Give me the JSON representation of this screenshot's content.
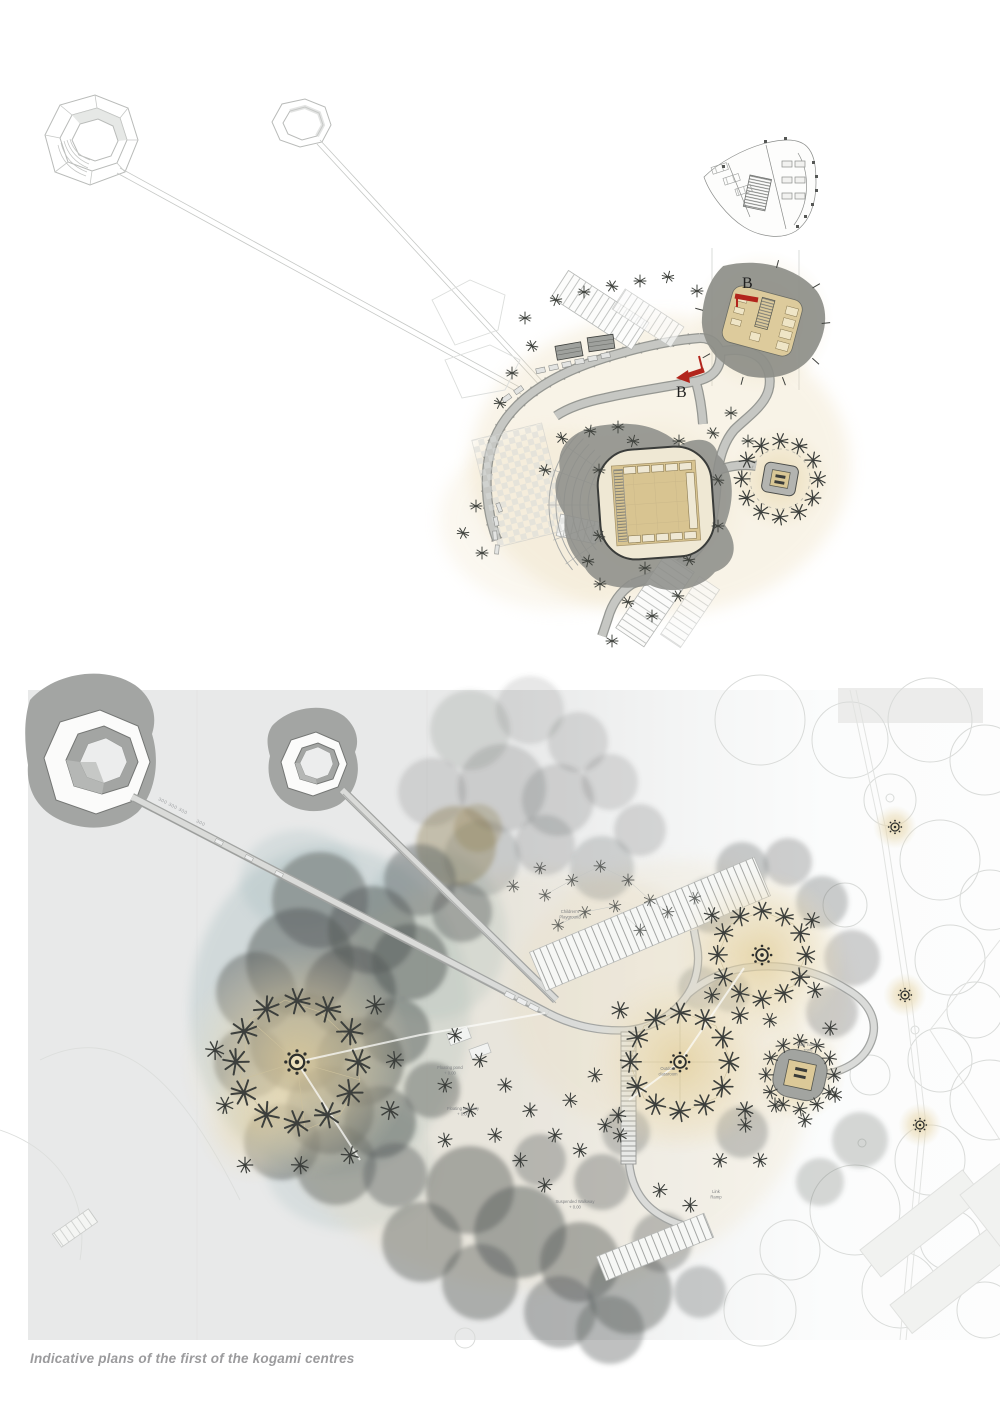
{
  "page": {
    "caption": "Indicative plans of the first of the kogami centres",
    "background": "#ffffff"
  },
  "colors": {
    "panel_gray": "#e8e9e9",
    "line_gray": "#b9bbb9",
    "walkway_gray": "#c6c7c3",
    "shadow_gray": "#8e8f8b",
    "floor_tan": "#d8c491",
    "glow_tan": "#e3cf9c",
    "tree_ink": "#3c3f3c",
    "watercolor_tree": "#565b59",
    "teal_wash": "#9fb7ba",
    "section_red": "#b2251c",
    "caption_gray": "#9b9b9d"
  },
  "top_plan": {
    "section_marker_1": "B",
    "section_marker_2": "B"
  },
  "bottom_plan": {
    "labels": {
      "playground_l1": "Children's",
      "playground_l2": "Playground",
      "classroom_l1": "Outdoor",
      "classroom_l2": "classroom",
      "nature_l1": "Kids' nature",
      "nature_l2": "zone",
      "pond_l1": "Floating pond",
      "pond_l2": "+ 0.00",
      "fwalk_l1": "Floating walkway",
      "fwalk_l2": "+ 0.00",
      "suspended_l1": "Suspended Walkway",
      "suspended_l2": "+ 0.00",
      "link_l1": "Link",
      "link_l2": "Ramp",
      "dims_a": "300  300  300",
      "dims_b": "300"
    }
  }
}
